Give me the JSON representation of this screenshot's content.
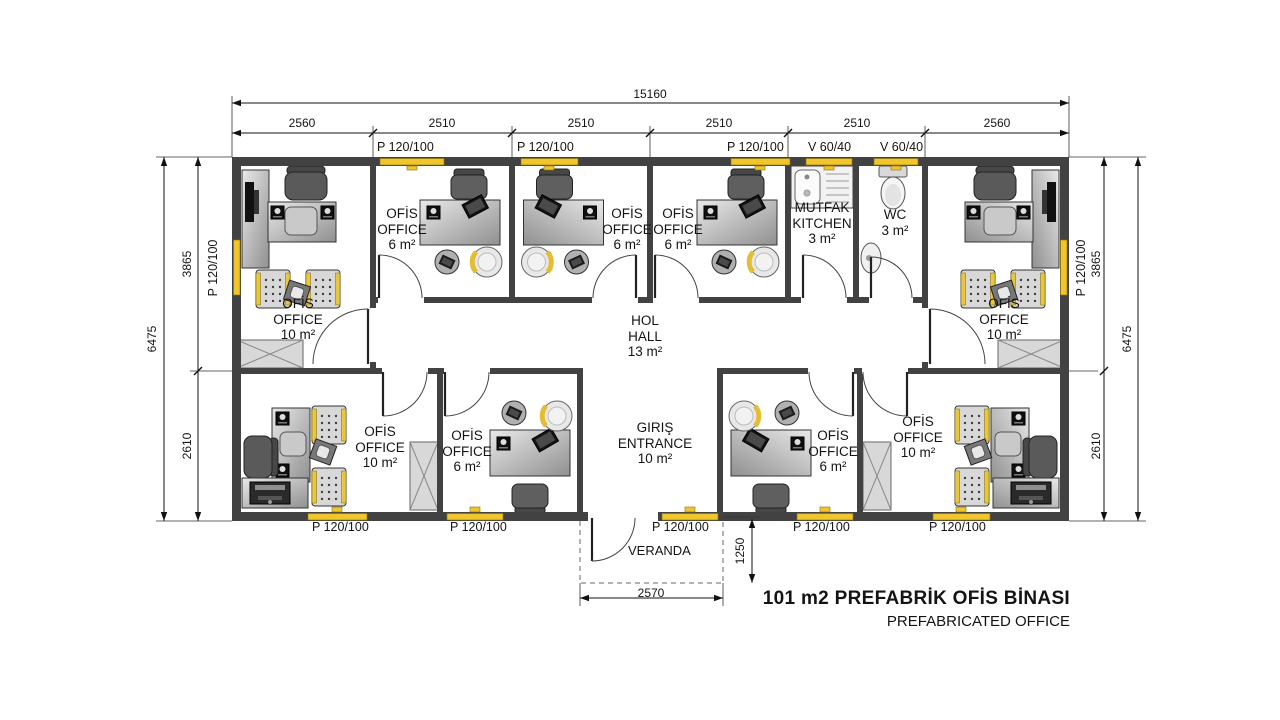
{
  "title": {
    "line1": "101 m2 PREFABRİK OFİS BİNASI",
    "line2": "PREFABRICATED OFFICE"
  },
  "dimensions": {
    "total_width": "15160",
    "top_segments": [
      "2560",
      "2510",
      "2510",
      "2510",
      "2510",
      "2560"
    ],
    "left": {
      "overall": "6475",
      "upper": "3865",
      "lower": "2610"
    },
    "right": {
      "overall": "6475",
      "upper": "3865",
      "lower": "2610"
    },
    "veranda": {
      "width": "2570",
      "depth": "1250"
    }
  },
  "openings": {
    "top": [
      "P 120/100",
      "P 120/100",
      "P 120/100",
      "V 60/40",
      "V 60/40"
    ],
    "bottom": [
      "P 120/100",
      "P 120/100",
      "P 120/100",
      "P 120/100",
      "P 120/100"
    ],
    "left": "P 120/100",
    "right": "P 120/100"
  },
  "rooms": [
    {
      "tr": "OFİS",
      "en": "OFFICE",
      "area": "10 m²"
    },
    {
      "tr": "OFİS",
      "en": "OFFICE",
      "area": "6 m²"
    },
    {
      "tr": "OFİS",
      "en": "OFFICE",
      "area": "6 m²"
    },
    {
      "tr": "OFİS",
      "en": "OFFICE",
      "area": "6 m²"
    },
    {
      "tr": "MUTFAK",
      "en": "KITCHEN",
      "area": "3 m²"
    },
    {
      "tr": "WC",
      "area": "3 m²"
    },
    {
      "tr": "OFİS",
      "en": "OFFICE",
      "area": "10 m²"
    },
    {
      "tr": "HOL",
      "en": "HALL",
      "area": "13 m²"
    },
    {
      "tr": "OFİS",
      "en": "OFFICE",
      "area": "10 m²"
    },
    {
      "tr": "OFİS",
      "en": "OFFICE",
      "area": "6 m²"
    },
    {
      "tr": "GIRIŞ",
      "en": "ENTRANCE",
      "area": "10 m²"
    },
    {
      "tr": "OFİS",
      "en": "OFFICE",
      "area": "6 m²"
    },
    {
      "tr": "OFİS",
      "en": "OFFICE",
      "area": "10 m²"
    }
  ],
  "veranda": {
    "label": "VERANDA"
  },
  "watermark": {
    "text": "prefabrik"
  }
}
